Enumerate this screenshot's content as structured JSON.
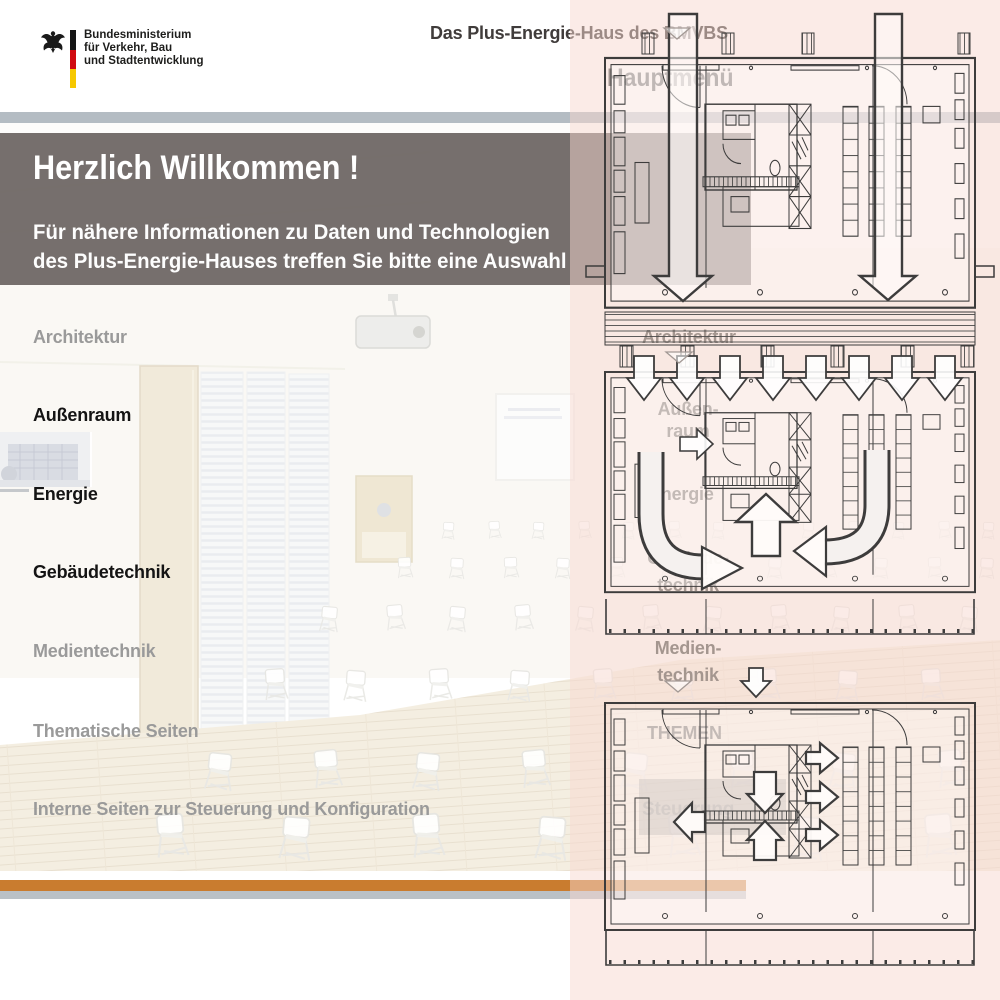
{
  "page": {
    "width": 1000,
    "height": 1000,
    "background": "#ffffff"
  },
  "logo": {
    "eagle_icon": "german-federal-eagle-icon",
    "flag_colors": {
      "black": "#151515",
      "red": "#d00b10",
      "gold": "#f6c800"
    },
    "ministry_lines": [
      "Bundesministerium",
      "für Verkehr, Bau",
      "und Stadtentwicklung"
    ]
  },
  "header": {
    "page_title": "Das Plus-Energie-Haus des BMVBS",
    "overlay_heading": "Hauptmenü"
  },
  "welcome": {
    "heading": "Herzlich Willkommen !",
    "intro_line1": "Für nähere Informationen zu Daten und Technologien",
    "intro_line2": "des Plus-Energie-Hauses treffen Sie bitte eine Auswahl"
  },
  "main_menu": {
    "items": [
      {
        "label": "Architektur",
        "emphasis": false
      },
      {
        "label": "Außenraum",
        "emphasis": true
      },
      {
        "label": "Energie",
        "emphasis": true
      },
      {
        "label": "Gebäudetechnik",
        "emphasis": true
      },
      {
        "label": "Medientechnik",
        "emphasis": false
      },
      {
        "label": "Thematische Seiten",
        "emphasis": false
      },
      {
        "label": "Interne Seiten zur Steuerung und Konfiguration",
        "emphasis": false
      }
    ]
  },
  "overlay_menu": {
    "items": [
      {
        "lines": [
          "Architektur"
        ]
      },
      {
        "lines": [
          "Außen-",
          "raum"
        ]
      },
      {
        "lines": [
          "Energie"
        ]
      },
      {
        "lines": [
          "Gebäude-",
          "technik"
        ]
      },
      {
        "lines": [
          "Medien-",
          "technik"
        ]
      },
      {
        "lines": [
          "THEMEN"
        ]
      },
      {
        "lines": [
          "Steuerung"
        ],
        "boxed": true
      }
    ]
  },
  "colors": {
    "accent_orange": "#c97c2f",
    "top_bar_gray": "#b4bcc3",
    "bottom_bar_gray": "#bac1c6",
    "welcome_box_gray": "#6a6361",
    "overlay_tint_pink": "#f7d8d0",
    "menu_active_text": "#141414",
    "menu_inactive_text": "#9a9a9a",
    "drawing_stroke": "#3d3c3c"
  },
  "decor": {
    "scroll_marker_icon": "triangle-down-icon",
    "drawing_icons": [
      "floorplan-downdraft-arrows-icon",
      "floorplan-circulation-arrows-icon",
      "floorplan-exhaust-arrows-icon"
    ]
  }
}
